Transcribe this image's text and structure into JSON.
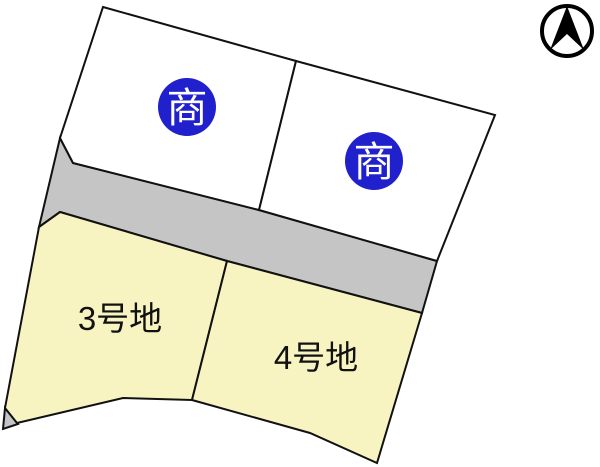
{
  "map": {
    "badges": {
      "upper_left": "商",
      "upper_right": "商"
    },
    "lots": {
      "lot3_label": "3号地",
      "lot4_label": "4号地"
    },
    "icons": {
      "north_arrow": "north-arrow-icon"
    },
    "colors": {
      "badge_blue": "#2020cd",
      "lot_yellow": "#f8f4c1",
      "road_gray": "#c5c5c5",
      "parcel_white": "#ffffff",
      "outline_black": "#111111"
    }
  }
}
